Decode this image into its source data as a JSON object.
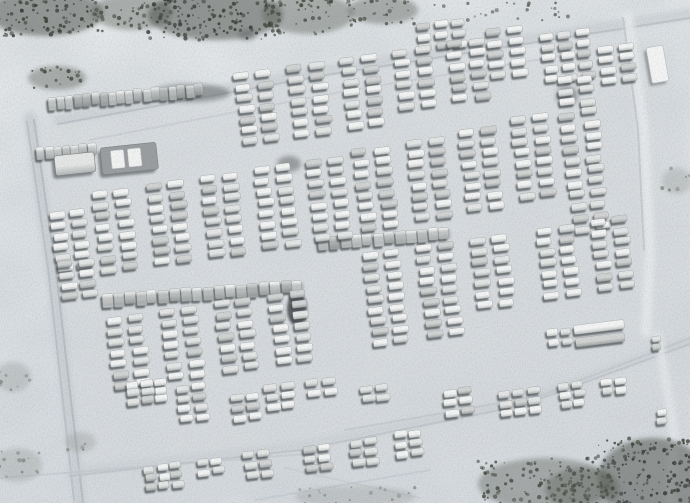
{
  "scene": {
    "width": 690,
    "height": 503,
    "palette": {
      "snow_top": "#e9eced",
      "snow_mid": "#e2e6e9",
      "snow_bottom": "#dce0e4",
      "yard_tint": "#d8dcdf",
      "mottle": "#b7bec5",
      "grain": "#5f6569",
      "vehicle_shadow": "#474b4e",
      "vehicle_stroke": "#9a9ea0",
      "veh_light_hi": "#f6f7f6",
      "veh_light_lo": "#c6c9c9",
      "veh_mid_hi": "#e7e9e8",
      "veh_mid_lo": "#b4b7b7",
      "veh_dark_hi": "#d4d6d5",
      "veh_dark_lo": "#a3a6a6",
      "scrub_dark": "#474b45",
      "scrub_mid": "#5f635c",
      "scrub_faint": "#8f938e",
      "speck_dark": "#33372f",
      "speck_mid": "#44483f",
      "speck_faint": "#858a85",
      "smudge": "#5b5f61",
      "blob": "#3c4044",
      "building_fill": "#f6f7f6",
      "building_stroke": "#c2c6c8",
      "truck_body": "#9b9fa1",
      "truck_panel": "#f4f5f4",
      "line_base": "#6a6e70"
    },
    "default_cluster": {
      "vw": 15,
      "vh": 7,
      "sx": 22,
      "sy": 10.8,
      "a": -7
    },
    "vehicle_clusters": [
      {
        "id": "t1",
        "x": 416,
        "y": 24,
        "cols": 3,
        "rows": 3,
        "vw": 13,
        "sx": 18
      },
      {
        "id": "t2",
        "x": 486,
        "y": 30,
        "cols": 2,
        "rows": 5
      },
      {
        "id": "t3",
        "x": 540,
        "y": 34,
        "cols": 3,
        "rows": 5,
        "vw": 13,
        "sx": 18
      },
      {
        "id": "t4",
        "x": 597,
        "y": 46,
        "cols": 2,
        "rows": 4
      },
      {
        "id": "s1",
        "x": 234,
        "y": 74,
        "cols": 2,
        "rows": 7
      },
      {
        "id": "s2",
        "x": 287,
        "y": 66,
        "cols": 2,
        "rows": 7
      },
      {
        "id": "s3",
        "x": 340,
        "y": 58,
        "cols": 2,
        "rows": 7
      },
      {
        "id": "s4",
        "x": 393,
        "y": 50,
        "cols": 2,
        "rows": 6
      },
      {
        "id": "s5",
        "x": 446,
        "y": 42,
        "cols": 2,
        "rows": 6
      },
      {
        "id": "m1",
        "x": 50,
        "y": 212,
        "cols": 2,
        "rows": 6,
        "sx": 20
      },
      {
        "id": "m2",
        "x": 92,
        "y": 192,
        "cols": 2,
        "rows": 8
      },
      {
        "id": "m3",
        "x": 146,
        "y": 184,
        "cols": 2,
        "rows": 8
      },
      {
        "id": "m4",
        "x": 200,
        "y": 176,
        "cols": 2,
        "rows": 8
      },
      {
        "id": "m5",
        "x": 254,
        "y": 168,
        "cols": 2,
        "rows": 8
      },
      {
        "id": "m6",
        "x": 306,
        "y": 160,
        "cols": 2,
        "rows": 8
      },
      {
        "id": "c1",
        "x": 352,
        "y": 150,
        "cols": 2,
        "rows": 8
      },
      {
        "id": "c2",
        "x": 406,
        "y": 140,
        "cols": 2,
        "rows": 8
      },
      {
        "id": "c3",
        "x": 458,
        "y": 130,
        "cols": 2,
        "rows": 8
      },
      {
        "id": "c4",
        "x": 510,
        "y": 118,
        "cols": 2,
        "rows": 8
      },
      {
        "id": "d1",
        "x": 556,
        "y": 78,
        "cols": 2,
        "rows": 14,
        "sy": 11.5,
        "sx": 21,
        "messy": 1.8
      },
      {
        "id": "n0",
        "x": 58,
        "y": 262,
        "cols": 2,
        "rows": 4,
        "sx": 20
      },
      {
        "id": "n1",
        "x": 106,
        "y": 318,
        "cols": 2,
        "rows": 7
      },
      {
        "id": "n2",
        "x": 160,
        "y": 310,
        "cols": 2,
        "rows": 7
      },
      {
        "id": "n3",
        "x": 214,
        "y": 302,
        "cols": 2,
        "rows": 7
      },
      {
        "id": "n4",
        "x": 268,
        "y": 294,
        "cols": 2,
        "rows": 7
      },
      {
        "id": "r1",
        "x": 362,
        "y": 254,
        "cols": 2,
        "rows": 9
      },
      {
        "id": "r2",
        "x": 416,
        "y": 246,
        "cols": 2,
        "rows": 9
      },
      {
        "id": "r3",
        "x": 470,
        "y": 238,
        "cols": 2,
        "rows": 7
      },
      {
        "id": "r4",
        "x": 536,
        "y": 228,
        "cols": 2,
        "rows": 7
      },
      {
        "id": "r5",
        "x": 590,
        "y": 220,
        "cols": 2,
        "rows": 7
      },
      {
        "id": "rl",
        "x": 574,
        "y": 326,
        "cols": 1,
        "rows": 2,
        "vw": 50,
        "vh": 9,
        "sy": 13
      },
      {
        "id": "sm1",
        "x": 546,
        "y": 330,
        "cols": 2,
        "rows": 2,
        "vw": 11,
        "sx": 14,
        "sy": 10
      },
      {
        "id": "sm2",
        "x": 652,
        "y": 336,
        "cols": 1,
        "rows": 2,
        "vw": 9,
        "vh": 6,
        "sy": 8
      },
      {
        "id": "b1",
        "x": 126,
        "y": 382,
        "cols": 3,
        "rows": 3,
        "vw": 12,
        "sx": 14,
        "sy": 8.5
      },
      {
        "id": "b2",
        "x": 176,
        "y": 386,
        "cols": 2,
        "rows": 4,
        "vw": 13,
        "sx": 16,
        "sy": 10
      },
      {
        "id": "b3",
        "x": 230,
        "y": 396,
        "cols": 2,
        "rows": 3,
        "vw": 13,
        "sx": 16,
        "sy": 10
      },
      {
        "id": "b4",
        "x": 264,
        "y": 384,
        "cols": 2,
        "rows": 3,
        "vw": 13,
        "sx": 16,
        "sy": 10
      },
      {
        "id": "b5",
        "x": 306,
        "y": 380,
        "cols": 2,
        "rows": 2,
        "vw": 13,
        "sx": 16,
        "sy": 10
      },
      {
        "id": "b6",
        "x": 360,
        "y": 386,
        "cols": 2,
        "rows": 2,
        "vw": 13,
        "sx": 16,
        "sy": 10
      },
      {
        "id": "b7",
        "x": 443,
        "y": 390,
        "cols": 2,
        "rows": 3,
        "vw": 13,
        "sx": 16,
        "sy": 10
      },
      {
        "id": "b8",
        "x": 498,
        "y": 392,
        "cols": 3,
        "rows": 3,
        "vw": 12,
        "sx": 15,
        "sy": 9
      },
      {
        "id": "b9",
        "x": 558,
        "y": 384,
        "cols": 2,
        "rows": 3,
        "vw": 11,
        "sx": 14,
        "sy": 9
      },
      {
        "id": "b10",
        "x": 600,
        "y": 380,
        "cols": 2,
        "rows": 2,
        "vw": 11,
        "sx": 14,
        "sy": 9
      },
      {
        "id": "b11",
        "x": 656,
        "y": 410,
        "cols": 1,
        "rows": 2,
        "vw": 10,
        "sy": 9
      },
      {
        "id": "b12",
        "x": 144,
        "y": 466,
        "cols": 3,
        "rows": 3,
        "vw": 11,
        "sx": 13,
        "sy": 9
      },
      {
        "id": "b13",
        "x": 196,
        "y": 460,
        "cols": 2,
        "rows": 2,
        "vw": 12,
        "sx": 15,
        "sy": 10
      },
      {
        "id": "b14",
        "x": 243,
        "y": 452,
        "cols": 2,
        "rows": 3,
        "vw": 12,
        "sx": 15,
        "sy": 10
      },
      {
        "id": "b15",
        "x": 303,
        "y": 446,
        "cols": 2,
        "rows": 3,
        "vw": 12,
        "sx": 15,
        "sy": 10
      },
      {
        "id": "b16",
        "x": 349,
        "y": 440,
        "cols": 2,
        "rows": 3,
        "vw": 12,
        "sx": 15,
        "sy": 10
      },
      {
        "id": "b17",
        "x": 394,
        "y": 432,
        "cols": 2,
        "rows": 3,
        "vw": 12,
        "sx": 15,
        "sy": 10
      }
    ],
    "vehicle_lines": [
      {
        "id": "h1",
        "x": 48,
        "y": 97,
        "count": 18,
        "spacing": 8.6,
        "vw": 8,
        "vh": 13,
        "a": -5
      },
      {
        "id": "h2",
        "x": 36,
        "y": 148,
        "count": 7,
        "spacing": 8.6,
        "vw": 8,
        "vh": 12,
        "a": -5
      },
      {
        "id": "h3",
        "x": 102,
        "y": 294,
        "count": 18,
        "spacing": 11.2,
        "vw": 10,
        "vh": 13,
        "a": -4
      },
      {
        "id": "h4",
        "x": 318,
        "y": 238,
        "count": 12,
        "spacing": 11,
        "vw": 10,
        "vh": 12,
        "a": -5
      }
    ],
    "large_vehicles": [
      {
        "id": "lv1",
        "x": 54,
        "y": 156,
        "w": 40,
        "h": 20,
        "a": -6,
        "panels": 0
      },
      {
        "id": "lv2",
        "x": 100,
        "y": 148,
        "w": 56,
        "h": 27,
        "a": -6,
        "panels": 2
      }
    ],
    "building": {
      "x": 646,
      "y": 48,
      "w": 17,
      "h": 36,
      "a": -10
    },
    "yard": {
      "x": 36,
      "y": 118,
      "w": 640,
      "h": 390,
      "a": -7,
      "opacity": 0.6
    },
    "roads": [
      {
        "id": "left-wide",
        "pts": [
          [
            30,
            118
          ],
          [
            52,
            270
          ],
          [
            80,
            503
          ]
        ],
        "w": 13,
        "color": "#cbd0d4",
        "op": 0.8,
        "soft": true
      },
      {
        "id": "left-track-a",
        "pts": [
          [
            34,
            120
          ],
          [
            56,
            272
          ],
          [
            83,
            503
          ]
        ],
        "w": 2,
        "color": "#b4bac0",
        "op": 0.8
      },
      {
        "id": "left-track-b",
        "pts": [
          [
            27,
            122
          ],
          [
            48,
            268
          ],
          [
            74,
            500
          ]
        ],
        "w": 2,
        "color": "#b8bec4",
        "op": 0.7
      },
      {
        "id": "top-wide",
        "pts": [
          [
            58,
            120
          ],
          [
            320,
            72
          ],
          [
            690,
            14
          ]
        ],
        "w": 11,
        "color": "#ccd1d5",
        "op": 0.7,
        "soft": true
      },
      {
        "id": "top-track",
        "pts": [
          [
            58,
            124
          ],
          [
            320,
            76
          ],
          [
            690,
            18
          ]
        ],
        "w": 2,
        "color": "#b7bdc3",
        "op": 0.7
      },
      {
        "id": "top-inner-track",
        "pts": [
          [
            90,
            140
          ],
          [
            340,
            92
          ],
          [
            560,
            56
          ]
        ],
        "w": 2,
        "color": "#c3c8cd",
        "op": 0.5
      },
      {
        "id": "right-wide",
        "pts": [
          [
            628,
            16
          ],
          [
            644,
            130
          ],
          [
            650,
            250
          ],
          [
            646,
            332
          ]
        ],
        "w": 10,
        "color": "#e9ebed",
        "op": 0.9,
        "soft": true
      },
      {
        "id": "right-track",
        "pts": [
          [
            623,
            18
          ],
          [
            638,
            130
          ],
          [
            644,
            250
          ]
        ],
        "w": 2,
        "color": "#b9bfc4",
        "op": 0.6
      },
      {
        "id": "bottom-wide",
        "pts": [
          [
            70,
            472
          ],
          [
            300,
            446
          ],
          [
            520,
            402
          ],
          [
            690,
            340
          ]
        ],
        "w": 9,
        "color": "#ccd1d5",
        "op": 0.6,
        "soft": true
      },
      {
        "id": "bottom-track",
        "pts": [
          [
            70,
            476
          ],
          [
            300,
            450
          ],
          [
            520,
            406
          ],
          [
            690,
            344
          ]
        ],
        "w": 2,
        "color": "#b9bfc5",
        "op": 0.6
      },
      {
        "id": "inner-diag-track",
        "pts": [
          [
            345,
            430
          ],
          [
            540,
            396
          ],
          [
            690,
            338
          ]
        ],
        "w": 2,
        "color": "#bcc2c7",
        "op": 0.5
      },
      {
        "id": "right-low-wide",
        "pts": [
          [
            658,
            336
          ],
          [
            674,
            430
          ],
          [
            670,
            503
          ]
        ],
        "w": 9,
        "color": "#e8eaec",
        "op": 0.8,
        "soft": true
      },
      {
        "id": "low-left-track",
        "pts": [
          [
            0,
            478
          ],
          [
            180,
            464
          ],
          [
            330,
            452
          ]
        ],
        "w": 2,
        "color": "#c0c6cb",
        "op": 0.5
      },
      {
        "id": "x-track-a",
        "pts": [
          [
            255,
            500
          ],
          [
            430,
            470
          ]
        ],
        "w": 2,
        "color": "#c0c6cb",
        "op": 0.5
      },
      {
        "id": "x-track-b",
        "pts": [
          [
            285,
            468
          ],
          [
            420,
            498
          ]
        ],
        "w": 2,
        "color": "#c3c8cd",
        "op": 0.45
      }
    ],
    "scrub_patches": [
      {
        "id": "p1",
        "x": -12,
        "y": -10,
        "w": 115,
        "h": 46,
        "tone": "dark"
      },
      {
        "id": "p2",
        "x": 92,
        "y": -6,
        "w": 80,
        "h": 36,
        "tone": "mid"
      },
      {
        "id": "p3",
        "x": 148,
        "y": -10,
        "w": 135,
        "h": 50,
        "tone": "dark"
      },
      {
        "id": "p4",
        "x": 262,
        "y": -6,
        "w": 92,
        "h": 40,
        "tone": "mid"
      },
      {
        "id": "p5",
        "x": 348,
        "y": -4,
        "w": 70,
        "h": 28,
        "tone": "mid"
      },
      {
        "id": "p6",
        "x": 420,
        "y": 2,
        "w": 150,
        "h": 24,
        "tone": "sparse"
      },
      {
        "id": "p7",
        "x": 598,
        "y": 438,
        "w": 110,
        "h": 80,
        "tone": "dark"
      },
      {
        "id": "p8",
        "x": 478,
        "y": 458,
        "w": 135,
        "h": 52,
        "tone": "mid"
      },
      {
        "id": "p9",
        "x": 295,
        "y": 486,
        "w": 120,
        "h": 22,
        "tone": "faint"
      },
      {
        "id": "p10",
        "x": 545,
        "y": 468,
        "w": 75,
        "h": 42,
        "tone": "mid"
      },
      {
        "id": "p11",
        "x": 662,
        "y": 168,
        "w": 30,
        "h": 26,
        "tone": "faint"
      },
      {
        "id": "p12",
        "x": 287,
        "y": 292,
        "w": 20,
        "h": 34,
        "tone": "blob"
      },
      {
        "id": "p13",
        "x": 152,
        "y": 84,
        "w": 78,
        "h": 18,
        "tone": "smudge"
      },
      {
        "id": "p14",
        "x": 277,
        "y": 156,
        "w": 24,
        "h": 16,
        "tone": "smudge"
      },
      {
        "id": "p15",
        "x": 28,
        "y": 66,
        "w": 58,
        "h": 24,
        "tone": "mid"
      },
      {
        "id": "p16",
        "x": 556,
        "y": 86,
        "w": 22,
        "h": 20,
        "tone": "smudge"
      },
      {
        "id": "p17",
        "x": -5,
        "y": 362,
        "w": 36,
        "h": 30,
        "tone": "faint"
      },
      {
        "id": "p18",
        "x": 66,
        "y": 432,
        "w": 30,
        "h": 20,
        "tone": "faint"
      },
      {
        "id": "p19",
        "x": -8,
        "y": 448,
        "w": 50,
        "h": 34,
        "tone": "faint"
      },
      {
        "id": "p20",
        "x": 238,
        "y": 30,
        "w": 18,
        "h": 10,
        "tone": "smudge"
      }
    ]
  }
}
